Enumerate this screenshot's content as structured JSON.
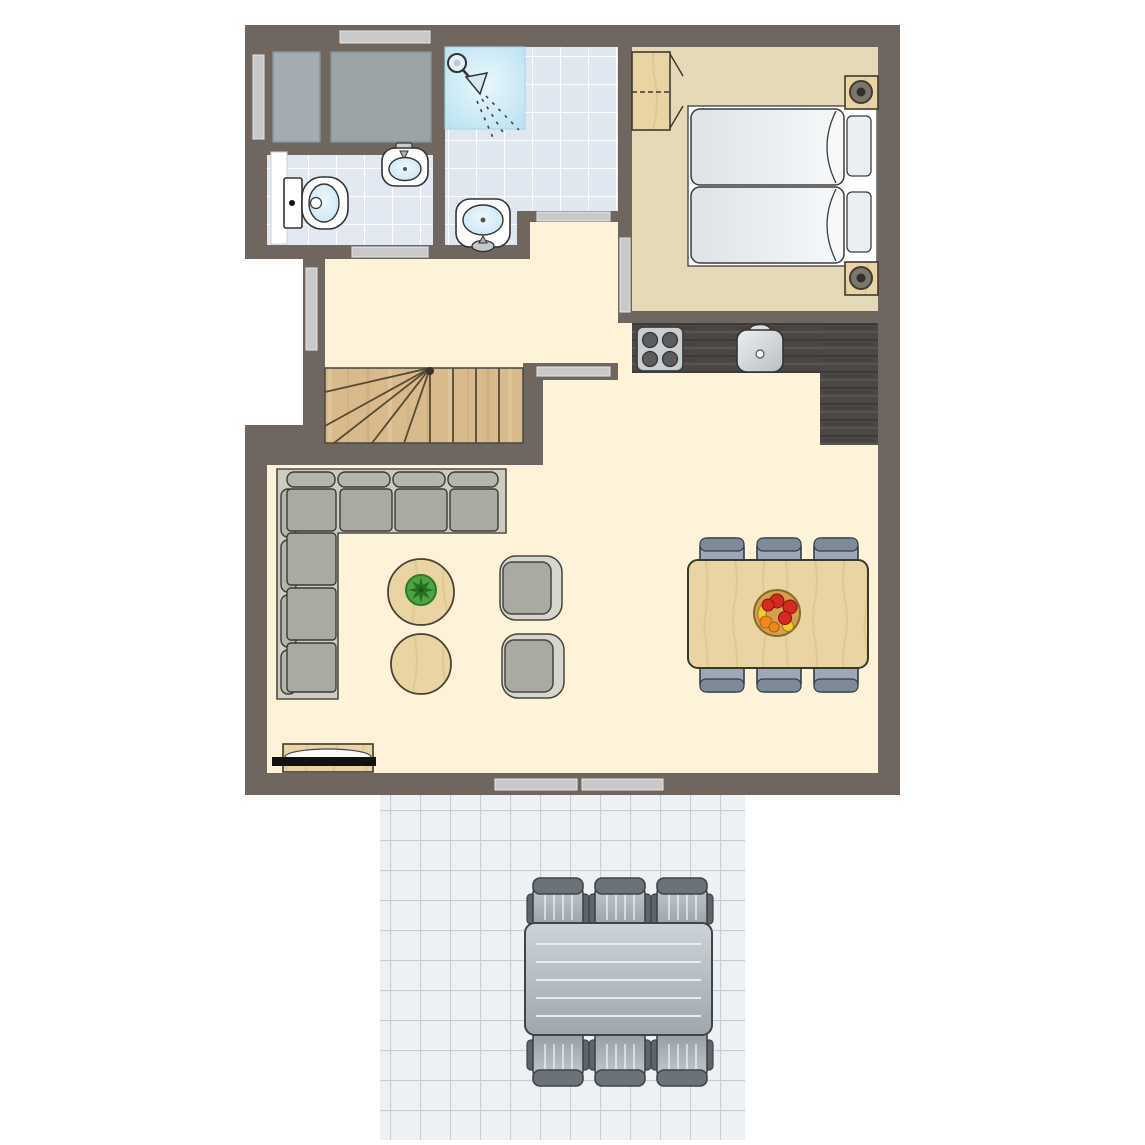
{
  "app": {
    "label": "holiday home floor plan, top-down view with terrace"
  },
  "colors": {
    "bg": "#FFFFFF",
    "wall": "#6F6660",
    "floor-living": "#FEF3D8",
    "floor-bedroom": "#E5DAB8",
    "floor-bath": "#E3E9F2",
    "floor-shower": "#DFE7F1",
    "shower-blue": "#B7E1F2",
    "floor-terrace": "#EEF1F4",
    "terrace-grout": "#C6CDD4",
    "stairs-wood": "#D8BA8C",
    "furniture-wood": "#EAD4A3",
    "counter-dark": "#4B4744",
    "door-bar": "#C9C9C9",
    "sofa-base": "#CCCDC0",
    "cushion": "#A9AAA2",
    "outline-dark": "#3B3B35",
    "dining-chair": "#9CA8B5",
    "outdoor-dark": "#6B7278",
    "fixture-blue": "#CFE7F5",
    "plant-green": "#4FA341",
    "fruit-red": "#D42B20",
    "fruit-orange": "#EE8A1C",
    "fruit-yellow": "#EFCB2D"
  },
  "rooms": [
    {
      "id": "storage",
      "label": "storage closets",
      "features": [
        "cabinet-left",
        "cabinet-right"
      ]
    },
    {
      "id": "bathroom",
      "label": "toilet room",
      "features": [
        "toilet",
        "washbasin",
        "door",
        "window"
      ]
    },
    {
      "id": "shower-room",
      "label": "shower room",
      "features": [
        "shower",
        "washbasin",
        "door"
      ]
    },
    {
      "id": "bedroom",
      "label": "bedroom",
      "features": [
        "wardrobe",
        "twin-beds",
        "nightstand-top",
        "nightstand-bottom",
        "door"
      ]
    },
    {
      "id": "hallway",
      "label": "hallway",
      "features": [
        "window",
        "stairs"
      ]
    },
    {
      "id": "kitchen",
      "label": "kitchen",
      "features": [
        "hob-4-burners",
        "sink",
        "l-shaped-counter"
      ]
    },
    {
      "id": "living-room",
      "label": "living and dining room",
      "features": [
        "corner-sofa",
        "coffee-table-with-plant",
        "coffee-table",
        "armchair-top",
        "armchair-bottom",
        "dining-table",
        "dining-chairs",
        "fruit-bowl",
        "tv-sideboard",
        "sliding-doors"
      ]
    },
    {
      "id": "terrace",
      "label": "terrace",
      "features": [
        "outdoor-table",
        "outdoor-chairs",
        "tiled-floor"
      ]
    }
  ],
  "counts": {
    "beds": 2,
    "dining_chairs": 6,
    "outdoor_chairs": 6,
    "armchairs": 2,
    "coffee_tables": 2,
    "washbasins": 2,
    "windows": 3,
    "sliding_door_panels": 2,
    "hob_burners": 4,
    "storage_cabinets": 2
  }
}
